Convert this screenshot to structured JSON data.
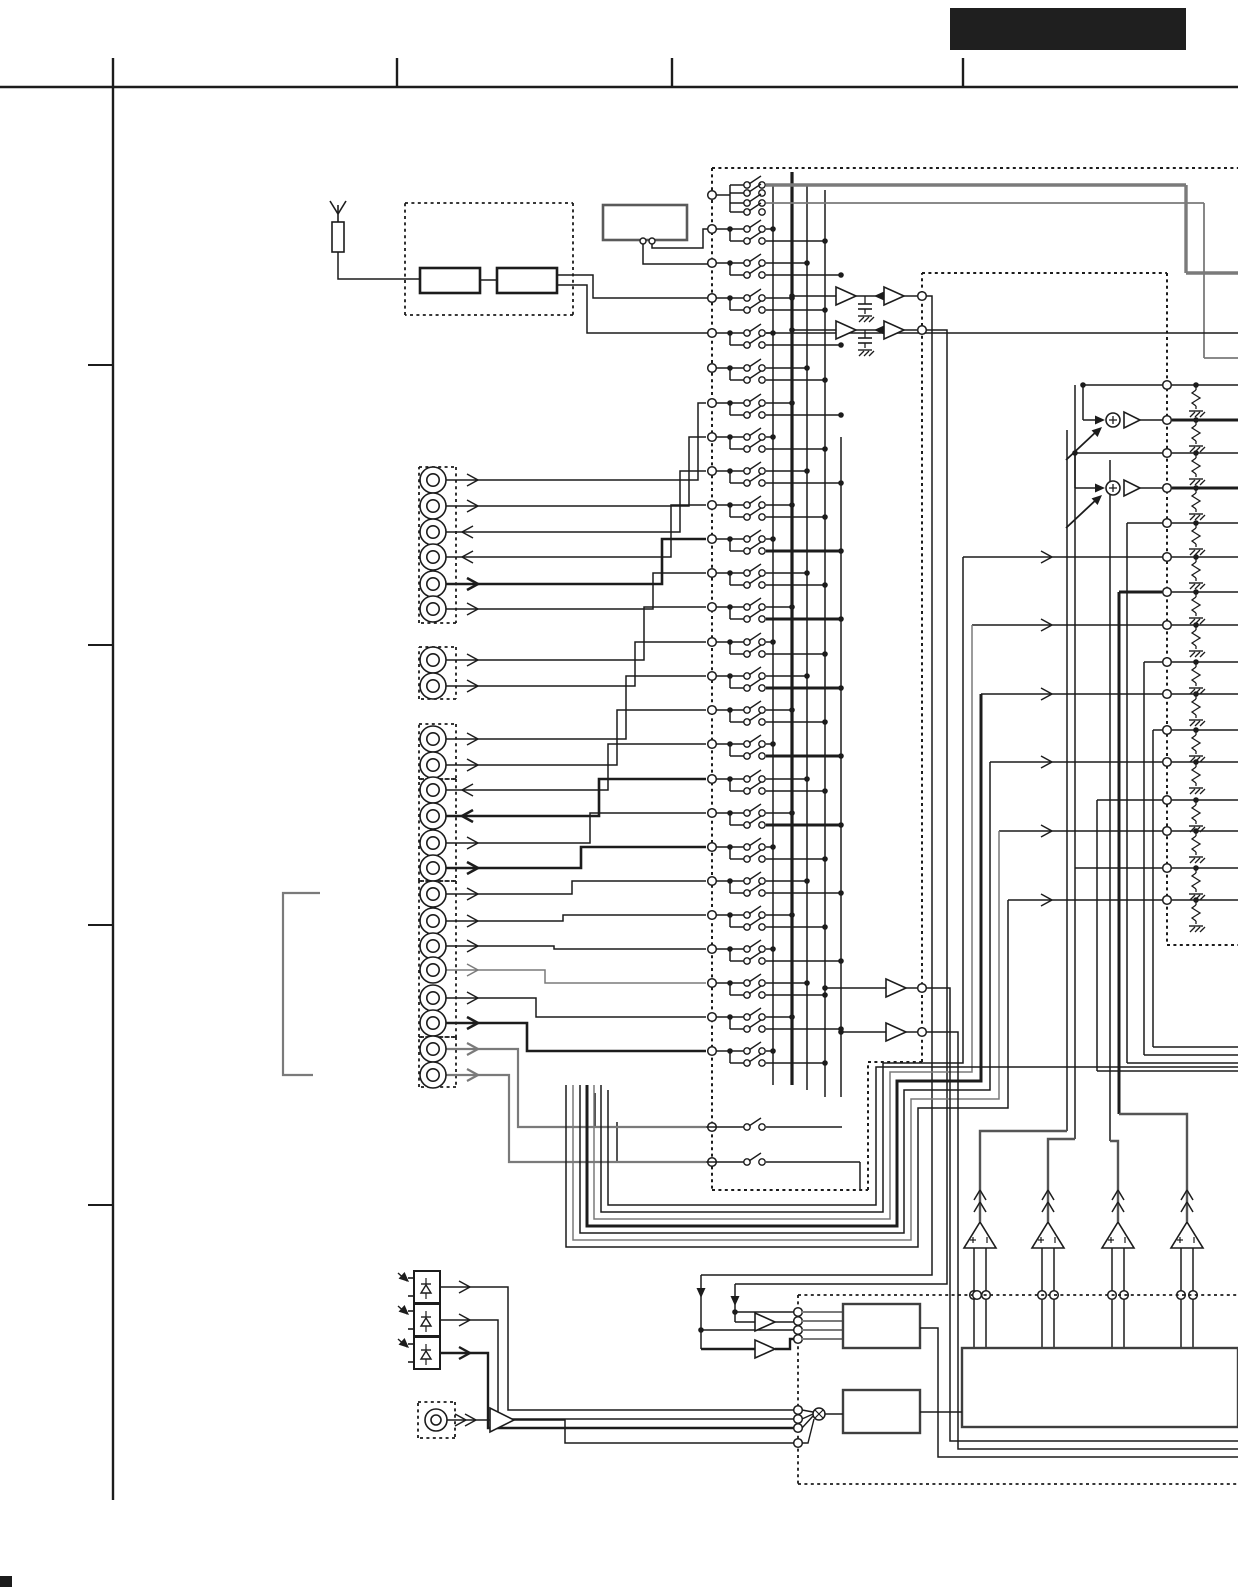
{
  "page": {
    "width": 1238,
    "height": 1587,
    "kind": "audio-receiver-schematic-page",
    "visible_text": "none"
  },
  "palette": {
    "paper": "#ffffff",
    "ink": "#1c1c1c",
    "gray": "#7a7a7a",
    "midgray": "#4a4a4a",
    "black_block": "#1f1f1f"
  },
  "frame": {
    "top_y": 87,
    "left_x": 113,
    "left_y1": 58,
    "left_y2": 1500,
    "ticks_top_x": [
      397,
      672,
      963
    ],
    "stub_y": [
      365,
      645,
      925,
      1205
    ],
    "corner_mark": [
      0,
      1576,
      12,
      11
    ]
  },
  "title_block": {
    "x": 950,
    "y": 8,
    "w": 236,
    "h": 42
  },
  "antenna": {
    "x": 338,
    "tip_y": 201,
    "res_top": 222,
    "res_bot": 252,
    "drop_y": 279
  },
  "tuner": {
    "box": [
      405,
      203,
      573,
      315
    ],
    "r1": [
      420,
      268,
      480,
      293
    ],
    "r2": [
      497,
      268,
      557,
      293
    ],
    "wireA": [
      [
        557,
        275
      ],
      [
        593,
        275
      ],
      [
        593,
        298
      ],
      [
        708,
        298
      ]
    ],
    "wireB": [
      [
        557,
        285
      ],
      [
        587,
        285
      ],
      [
        587,
        333
      ],
      [
        708,
        333
      ]
    ]
  },
  "preset": {
    "box": [
      603,
      205,
      687,
      240
    ],
    "pins": [
      [
        643,
        241
      ],
      [
        652,
        241
      ]
    ],
    "wire1": [
      [
        652,
        244
      ],
      [
        652,
        248
      ],
      [
        703,
        248
      ],
      [
        703,
        229
      ],
      [
        708,
        229
      ]
    ],
    "wire2": [
      [
        643,
        244
      ],
      [
        643,
        264
      ],
      [
        708,
        264
      ]
    ]
  },
  "switch_matrix": {
    "dash": [
      [
        712,
        168,
        1238,
        168
      ],
      [
        712,
        168,
        712,
        1190
      ],
      [
        712,
        1190,
        868,
        1190
      ],
      [
        868,
        1190,
        868,
        1062
      ],
      [
        868,
        1062,
        922,
        1062
      ],
      [
        922,
        1062,
        922,
        273
      ],
      [
        922,
        273,
        1167,
        273
      ],
      [
        1167,
        273,
        1167,
        945
      ],
      [
        1167,
        945,
        1238,
        945
      ]
    ],
    "terminal_rows": [
      229,
      263,
      298,
      333,
      368,
      403,
      437,
      471,
      505,
      539,
      573,
      607,
      642,
      676,
      710,
      744,
      779,
      813,
      847,
      881,
      915,
      949,
      983,
      1017,
      1051
    ],
    "top_group": {
      "terminal_y": 195,
      "rows": [
        185,
        193,
        203,
        212
      ]
    },
    "buses": [
      {
        "x": 773,
        "y1": 185,
        "y2": 1085
      },
      {
        "x": 792,
        "y1": 172,
        "y2": 1085,
        "w": 3.2
      },
      {
        "x": 807,
        "y1": 185,
        "y2": 1090
      },
      {
        "x": 825,
        "y1": 190,
        "y2": 1097
      },
      {
        "x": 841,
        "y1": 437,
        "y2": 1097
      }
    ],
    "long_row_y": 333,
    "singles": [
      {
        "feed_x": 595,
        "feed_y": 1093,
        "y": 1127,
        "end": 842
      },
      {
        "feed_x": 617,
        "feed_y": 1122,
        "y": 1162,
        "end": 860,
        "drop": 1190
      }
    ]
  },
  "top_bus_runs": [
    {
      "y": 185,
      "vx": 1186,
      "down_to": 273,
      "stroke": "gray",
      "w": 3.4
    },
    {
      "y": 193,
      "vx": 1195,
      "down_to": 263,
      "stroke": "ink",
      "w": 1.5
    },
    {
      "y": 203,
      "vx": 1204,
      "down_to": 358,
      "stroke": "gray",
      "w": 1.8
    },
    {
      "y": 212,
      "vx": 1213,
      "down_to": 323,
      "stroke": "ink",
      "w": 3.2
    }
  ],
  "rec_out_rows": [
    {
      "y": 296,
      "vx": 932,
      "drop_to": 1275,
      "left_x": 701
    },
    {
      "y": 330,
      "vx": 947,
      "drop_to": 1284,
      "left_x": 735
    }
  ],
  "jacks": {
    "box_x1": 419,
    "box_x2": 456,
    "cx": 433,
    "groups": [
      [
        467,
        623
      ],
      [
        647,
        699
      ],
      [
        724,
        779
      ],
      [
        779,
        881
      ],
      [
        881,
        1037
      ],
      [
        1037,
        1087
      ]
    ],
    "rows": [
      {
        "y": 480
      },
      {
        "y": 506
      },
      {
        "y": 532,
        "dir": "left"
      },
      {
        "y": 557,
        "dir": "left"
      },
      {
        "y": 584,
        "w": 2.6
      },
      {
        "y": 609
      },
      {
        "y": 660
      },
      {
        "y": 686
      },
      {
        "y": 739
      },
      {
        "y": 765
      },
      {
        "y": 790,
        "dir": "left"
      },
      {
        "y": 816,
        "dir": "left",
        "w": 2.6
      },
      {
        "y": 843
      },
      {
        "y": 868,
        "w": 2.6
      },
      {
        "y": 894
      },
      {
        "y": 921
      },
      {
        "y": 946
      },
      {
        "y": 970,
        "stroke": "gray"
      },
      {
        "y": 998
      },
      {
        "y": 1023,
        "w": 2.6
      },
      {
        "y": 1049,
        "stroke": "gray",
        "w": 2.2
      },
      {
        "y": 1075,
        "stroke": "gray",
        "w": 2.2
      }
    ],
    "pairs": [
      [
        480,
        506
      ],
      [
        532,
        557
      ],
      [
        584,
        609
      ],
      [
        660,
        686
      ],
      [
        739,
        765
      ],
      [
        790,
        816
      ],
      [
        843,
        868
      ],
      [
        894,
        921
      ],
      [
        946,
        970
      ],
      [
        998,
        1023
      ],
      [
        1049,
        1075
      ]
    ],
    "route_targets": [
      403,
      437,
      471,
      505,
      539,
      573,
      607,
      642,
      676,
      710,
      744,
      779,
      813,
      847,
      881,
      915,
      949,
      983,
      1017,
      1051,
      1127,
      1162
    ],
    "route_bend_start": 698,
    "route_bend_step": 9
  },
  "right_panel": {
    "terminal_x": 1167,
    "node_x": 1196,
    "edge_x": 1238,
    "rows": [
      385,
      420,
      453,
      488,
      523,
      557,
      592,
      625,
      662,
      694,
      730,
      762,
      800,
      831,
      868,
      900
    ],
    "arrow_rows": [
      557,
      625,
      694,
      762,
      831,
      900
    ],
    "arrow_row_src_x": [
      963,
      972,
      981,
      990,
      999,
      1008
    ],
    "sum_stages": [
      {
        "src": 385,
        "sum": 420,
        "src_x": 1083
      },
      {
        "src": 453,
        "sum": 488,
        "src_x": 1075
      }
    ],
    "feed_rows": [
      {
        "y": 523,
        "x": 1127
      },
      {
        "y": 592,
        "x": 1119,
        "w": 3
      },
      {
        "y": 662,
        "x": 1144
      },
      {
        "y": 730,
        "x": 1153
      },
      {
        "y": 800,
        "x": 1097
      },
      {
        "y": 868,
        "x": 1075
      }
    ],
    "verticals": [
      {
        "x": 1067,
        "y1": 430,
        "y2": 1131
      },
      {
        "x": 1075,
        "y1": 385,
        "y2": 1139
      },
      {
        "x": 1097,
        "y1": 800,
        "y2": 1071
      },
      {
        "x": 1110,
        "y1": 460,
        "y2": 1141
      },
      {
        "x": 1119,
        "y1": 592,
        "y2": 1114,
        "w": 3
      },
      {
        "x": 1127,
        "y1": 523,
        "y2": 1063
      },
      {
        "x": 1144,
        "y1": 662,
        "y2": 1055
      },
      {
        "x": 1153,
        "y1": 730,
        "y2": 1047
      }
    ],
    "edge_bends": [
      {
        "x": 1127,
        "y": 1063
      },
      {
        "x": 1144,
        "y": 1055
      },
      {
        "x": 1153,
        "y": 1047
      },
      {
        "x": 1097,
        "y": 1071
      }
    ]
  },
  "bundle": [
    {
      "xl": 566,
      "yb": 1247,
      "xr": 918,
      "yt": 1108,
      "xm": 1008,
      "row": 900
    },
    {
      "xl": 573,
      "yb": 1240,
      "xr": 911,
      "yt": 1099,
      "xm": 999,
      "row": 831,
      "stroke": "gray"
    },
    {
      "xl": 580,
      "yb": 1233,
      "xr": 904,
      "yt": 1090,
      "xm": 990,
      "row": 762
    },
    {
      "xl": 587,
      "yb": 1226,
      "xr": 897,
      "yt": 1081,
      "xm": 981,
      "row": 694,
      "w": 3
    },
    {
      "xl": 594,
      "yb": 1219,
      "xr": 890,
      "yt": 1072,
      "xm": 972,
      "row": 625,
      "stroke": "gray"
    },
    {
      "xl": 601,
      "yb": 1212,
      "xr": 883,
      "yt": 1063,
      "xm": 963,
      "row": 557
    }
  ],
  "mon_amps": [
    {
      "y": 988,
      "bus": 825,
      "out_x": 950,
      "drop": 1441
    },
    {
      "y": 1032,
      "bus": 841,
      "out_x": 958,
      "drop": 1449
    }
  ],
  "power_amps": {
    "cx": [
      980,
      1048,
      1118,
      1187
    ],
    "apex": 1222,
    "base": 1248,
    "dash_y": 1295,
    "box_top": 1348,
    "bends": [
      {
        "to_x": 1067,
        "at_y": 1131
      },
      {
        "to_x": 1075,
        "at_y": 1139
      },
      {
        "to_x": 1110,
        "at_y": 1141
      },
      {
        "to_x": 1119,
        "at_y": 1114
      }
    ]
  },
  "bottom": {
    "dash": [
      [
        798,
        1295,
        1238,
        1295
      ],
      [
        798,
        1295,
        798,
        1484
      ],
      [
        798,
        1484,
        1238,
        1484
      ]
    ],
    "in_terms": [
      1312,
      1321,
      1330,
      1339
    ],
    "mix_terms": [
      1410,
      1419,
      1428,
      1443
    ],
    "box_a": [
      843,
      1304,
      920,
      1348
    ],
    "box_b": [
      843,
      1390,
      920,
      1433
    ],
    "box_c": [
      962,
      1348,
      1238,
      1427
    ],
    "amp1": {
      "in_x": 735,
      "y": 1322
    },
    "amp2": {
      "in_x": 701,
      "y": 1349,
      "w": 2.6
    },
    "a_out": [
      [
        920,
        1328
      ],
      [
        938,
        1328
      ],
      [
        938,
        1457
      ],
      [
        1238,
        1457
      ]
    ],
    "b_out": [
      [
        920,
        1412
      ],
      [
        962,
        1412
      ]
    ],
    "opt_y": [
      1287,
      1320,
      1353
    ],
    "opt_routes": [
      {
        "bx": 508,
        "ty": 1410
      },
      {
        "bx": 498,
        "ty": 1419
      },
      {
        "bx": 488,
        "ty": 1428
      }
    ],
    "coax": {
      "jack": [
        436,
        1420
      ],
      "amp_x": 490,
      "route": [
        [
          514,
          1420
        ],
        [
          565,
          1420
        ],
        [
          565,
          1443
        ],
        [
          798,
          1443
        ]
      ]
    },
    "mixer": [
      819,
      1414
    ]
  },
  "bracket": {
    "pts": [
      [
        320,
        893
      ],
      [
        283,
        893
      ],
      [
        283,
        1075
      ],
      [
        313,
        1075
      ]
    ]
  },
  "components": {
    "antenna": "FM antenna input",
    "tuner": "front-end / IF tuner modules",
    "preset": "preset memory block",
    "matrix": "input selector switch matrix",
    "jacks": "analog RCA input/output jacks",
    "right_panel": "speaker/output terminal RC networks",
    "sum": "volume summing stages",
    "power_amps": "power amplifier channels",
    "optical": "optical digital inputs",
    "coax": "coaxial digital input",
    "boxes": "DIR / system control ICs"
  }
}
